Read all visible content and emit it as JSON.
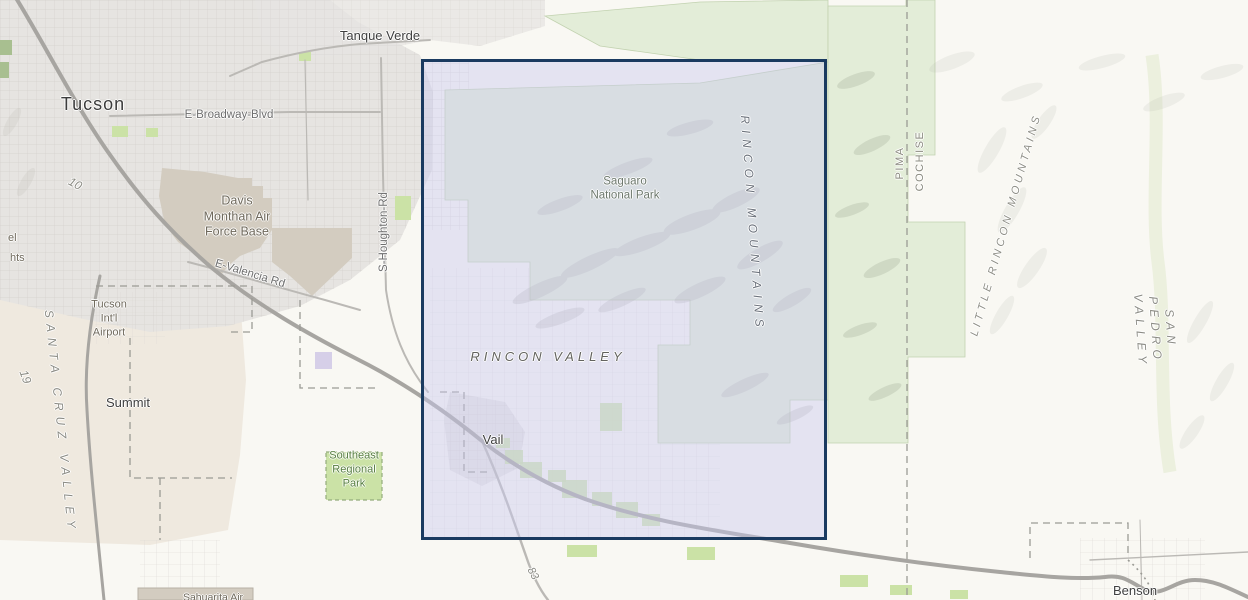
{
  "map": {
    "labels": {
      "tucson": "Tucson",
      "tanque_verde": "Tanque Verde",
      "e_broadway": "E-Broadway-Blvd",
      "davis_monthan": "Davis\nMonthan Air\nForce Base",
      "e_valencia": "E-Valencia Rd",
      "s_houghton": "S-Houghton-Rd",
      "tucson_airport": "Tucson\nInt'l\nAirport",
      "summit": "Summit",
      "southeast_park": "Southeast\nRegional\nPark",
      "santa_cruz_valley": "SANTA CRUZ VALLEY",
      "rincon_valley": "RINCON VALLEY",
      "vail": "Vail",
      "saguaro_np": "Saguaro\nNational Park",
      "rincon_mountains": "RINCON MOUNTAINS",
      "pima": "PIMA",
      "cochise": "COCHISE",
      "little_rincon_mountains": "LITTLE RINCON MOUNTAINS",
      "san_pedro_valley": "SAN PEDRO VALLEY",
      "benson": "Benson",
      "hwy_10": "10",
      "hwy_19": "19",
      "hwy_83": "83",
      "edge_partial_el": "el",
      "edge_partial_hts": "hts",
      "sahuarita_air": "Sahuarita Air"
    },
    "selection": {
      "x": 421,
      "y": 59,
      "width": 406,
      "height": 481
    },
    "palette": {
      "background": "#f9f8f3",
      "urban": "#e6e4e1",
      "valley_beige": "#efe9df",
      "park_green": "#e3edd8",
      "bright_green": "#cbe2a6",
      "military_tan": "#d3ccc0",
      "road_major": "#a7a5a1",
      "road_minor": "#bbb9b5",
      "boundary_dash": "#9b9b95",
      "selection_fill": "#c9c9ef",
      "selection_border": "#1a3a60",
      "terrain": "#a3a299"
    }
  }
}
